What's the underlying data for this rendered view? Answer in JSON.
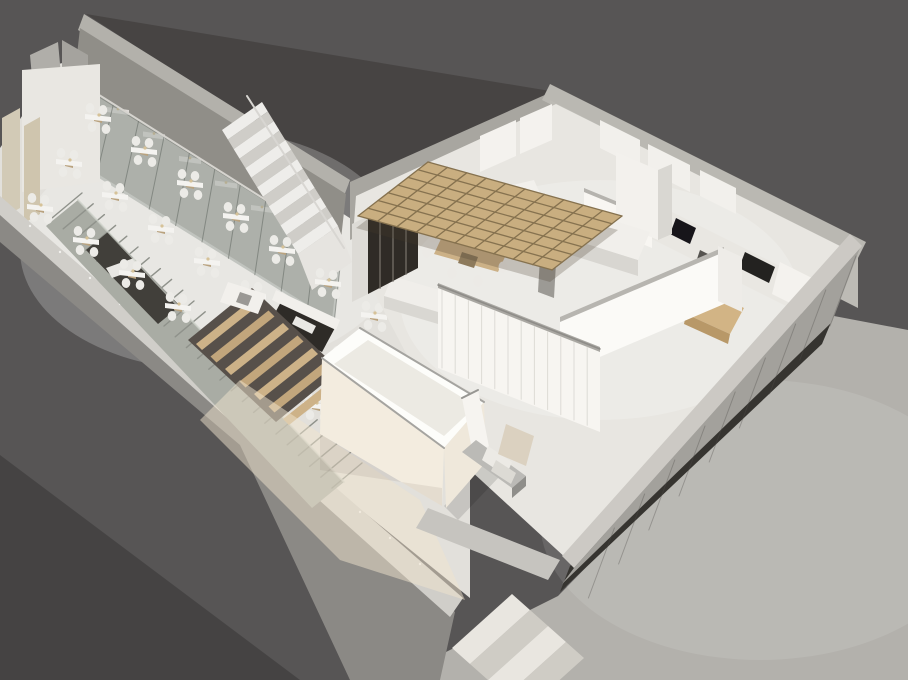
{
  "scene": {
    "name": "3d-axonometric-restaurant-floorplan-render",
    "canvas": {
      "width": 908,
      "height": 680
    },
    "palette": {
      "background": "#575555",
      "background_corner": "#434241",
      "roof_dark": "#474443",
      "wall_cap": "#cfcdc8",
      "wall_face_gray": "#8e8c88",
      "hall_floor": "#e2e0db",
      "kitchen_floor": "#e8e6e1",
      "sidewalk": "#b3b1ac",
      "glass_tint": "rgba(139,148,141,0.42)",
      "wood_light": "#cdb288",
      "pergola_wood": "#c9ae80",
      "dark_cabinet": "#2f2b26",
      "facade_base_dark": "#363430",
      "white_furniture": "#f2f0ec",
      "metal": "#bbbab6"
    },
    "shapes": [
      {
        "n": "background",
        "t": "r",
        "x": 0,
        "y": 0,
        "w": 908,
        "h": 680,
        "f": "#575555"
      },
      {
        "n": "background-corner-shade",
        "p": "0,455 300,680 0,680",
        "f": "#454343"
      },
      {
        "n": "roof-slab-dark",
        "p": "86,14 556,92 348,184",
        "f": "#474443"
      },
      {
        "n": "sidewalk",
        "p": "834,316 908,330 908,680 390,680 558,596 830,318",
        "f": "#b3b1ac"
      },
      {
        "n": "sidewalk-sheen",
        "t": "e",
        "cx": 760,
        "cy": 520,
        "rx": 220,
        "ry": 140,
        "f": "rgba(255,255,255,0.10)"
      },
      {
        "n": "hall-floor",
        "p": "96,56 356,222 470,400 470,598 0,218 0,148 58,64",
        "f": "#e2e0db"
      },
      {
        "n": "hall-floor-sheen",
        "t": "e",
        "cx": 210,
        "cy": 250,
        "rx": 190,
        "ry": 120,
        "f": "rgba(255,255,255,0.22)"
      },
      {
        "n": "backwall-cap",
        "p": "84,14 350,180 344,196 78,30",
        "f": "#b3b1ab"
      },
      {
        "n": "backwall-face",
        "p": "80,28 346,194 340,248 74,82",
        "f": "#908e88"
      },
      {
        "n": "glass-corridor-floor",
        "p": "74,82 340,248 332,320 66,154",
        "f": "#c7c5bf"
      },
      {
        "gen": "boothTables",
        "n": "booth-table",
        "origin": [
          118,
          110
        ],
        "step": [
          36,
          24.5
        ],
        "count": 7,
        "rel": [
          [
            -11,
            -3
          ],
          [
            11,
            0
          ],
          [
            11,
            5
          ],
          [
            -11,
            2
          ]
        ],
        "f": "#f0eeeb",
        "o": 0.8,
        "lamp": {
          "dx": 0,
          "dy": -1,
          "r": 1.4,
          "f": "#d6c298"
        }
      },
      {
        "n": "glass-partition",
        "p": "88,88 342,248 334,324 70,160",
        "f": "rgba(139,148,141,0.42)"
      },
      {
        "gen": "lines2",
        "n": "glass-mullion",
        "a0": [
          88,
          88
        ],
        "aStep": [
          25.4,
          16
        ],
        "b0": [
          70,
          160
        ],
        "bStep": [
          26.4,
          16.4
        ],
        "count": 11,
        "s": "rgba(90,95,90,0.5)",
        "sw": 1
      },
      {
        "n": "glass-top-rail",
        "t": "l",
        "x1": 88,
        "y1": 88,
        "x2": 342,
        "y2": 248,
        "s": "#d6d4cf",
        "sw": 2
      },
      {
        "n": "partition-wall-a",
        "p": "30,55 58,42 62,86 34,99",
        "f": "#b0aea9"
      },
      {
        "n": "partition-wall-b",
        "p": "62,40 88,55 88,95 62,80",
        "f": "#a5a39e"
      },
      {
        "n": "end-wall-white",
        "p": "22,70 100,64 100,182 22,192",
        "f": "#e9e7e2"
      },
      {
        "n": "beige-panel-1",
        "p": "2,118 20,108 20,208 2,218",
        "f": "#d2cab6"
      },
      {
        "n": "beige-panel-2",
        "p": "24,126 40,117 40,214 24,223",
        "f": "#cfc5ae"
      },
      {
        "n": "lower-wall-outer-face",
        "p": "0,212 455,612 440,680 350,680 240,445 0,242",
        "f": "#8b8985"
      },
      {
        "n": "lower-wall-cap",
        "p": "0,196 463,598 450,617 0,215",
        "f": "#d0cec9"
      },
      {
        "gen": "dots",
        "n": "cap-fastener",
        "start": [
          30,
          226
        ],
        "step": [
          30,
          26
        ],
        "count": 14,
        "r": 1.2,
        "f": "#f2f1ee"
      },
      {
        "n": "ramp-strip",
        "p": "46,226 78,200 344,482 312,508",
        "f": "#a9aca4"
      },
      {
        "gen": "lines",
        "n": "ramp-ridge",
        "from": [
          52,
          218
        ],
        "step": [
          11.2,
          10.8
        ],
        "count": 26,
        "vec": [
          30,
          -25
        ],
        "s": "#8f928b",
        "sw": 1.4
      },
      {
        "n": "ramp-inset-dark",
        "p": "86,250 108,232 180,306 158,324",
        "f": "#413f3a"
      },
      {
        "n": "ramp-inset-object",
        "p": "106,268 134,258 140,268 112,278",
        "f": "#e8e7e3"
      },
      {
        "n": "ramp-balustrade",
        "t": "l",
        "x1": 78,
        "y1": 200,
        "x2": 344,
        "y2": 482,
        "s": "#d0d4cc",
        "sw": 2,
        "o": 0.7
      },
      {
        "gen": "bands",
        "n": "stair-tread",
        "start": [
          222,
          130
        ],
        "w": [
          40,
          -28
        ],
        "f": [
          5.85,
          9.54
        ],
        "count": 13,
        "f1": "#eeedea",
        "f2": "#cfcdc8"
      },
      {
        "n": "stair-landing",
        "p": "298,254 338,226 352,262 312,290",
        "f": "#e6e4e0"
      },
      {
        "n": "stair-handrail",
        "t": "l",
        "x1": 247,
        "y1": 96,
        "x2": 344,
        "y2": 248,
        "s": "#d8d6d2",
        "sw": 2
      },
      {
        "gen": "tables",
        "n": "dining-table",
        "origin": [
          98,
          118
        ],
        "rowStep": [
          46,
          33
        ],
        "colStep": [
          -29,
          45
        ],
        "rows": 7,
        "cols": 3,
        "topRel": [
          [
            -13,
            -4
          ],
          [
            13,
            -1
          ],
          [
            13,
            4
          ],
          [
            -13,
            1
          ]
        ],
        "topF": "#f4f3f0",
        "baseRel": [
          [
            -4,
            0
          ],
          [
            4,
            2
          ],
          [
            4,
            5
          ],
          [
            -4,
            3
          ]
        ],
        "baseF": "#b9a27e",
        "chairs": [
          [
            -8,
            -10
          ],
          [
            5,
            -8
          ],
          [
            -6,
            9
          ],
          [
            8,
            11
          ]
        ],
        "chairR": [
          4.3,
          5
        ],
        "chairF": "#ecebe7",
        "lamp": {
          "dx": 1,
          "dy": -3,
          "r": 1.6,
          "f": "#d6c298"
        }
      },
      {
        "n": "stairwell-pit",
        "p": "282,300 336,326 322,352 268,326",
        "f": "#2e2b27"
      },
      {
        "n": "stairwell-object",
        "p": "296,316 316,326 312,334 292,324",
        "f": "#e9e8e4"
      },
      {
        "n": "stairwell-edge",
        "p": "276,290 340,320 336,330 272,300",
        "f": "#f1efeb"
      },
      {
        "n": "wood-steps-shadow",
        "p": "188,340 252,288 340,370 276,422",
        "f": "#57504a"
      },
      {
        "gen": "beams",
        "n": "wood-step-beam",
        "start": [
          196,
          344
        ],
        "step": [
          14.5,
          12.5
        ],
        "count": 7,
        "vec": [
          58,
          -46
        ],
        "wvec": [
          6,
          6
        ],
        "f1": "#cdb288",
        "f2": "#c2a67c"
      },
      {
        "n": "host-table",
        "p": "228,282 266,294 258,314 220,302",
        "f": "#f2f0ec"
      },
      {
        "n": "host-table-item",
        "p": "240,292 252,296 248,306 236,302",
        "f": "#9a9894"
      },
      {
        "n": "kitchen-nw-wall",
        "p": "350,182 556,90 556,148 350,240",
        "f": "#a8a6a0"
      },
      {
        "n": "kitchen-ne-cap",
        "p": "550,84 866,242 858,258 542,100",
        "f": "#bab8b2"
      },
      {
        "n": "kitchen-ne-wall",
        "p": "550,100 858,256 858,308 550,152",
        "f": "#bdbbb5"
      },
      {
        "n": "kitchen-floor",
        "p": "356,196 556,104 852,252 568,560 470,470 420,380 352,250",
        "f": "#e8e6e1"
      },
      {
        "n": "kitchen-floor-sheen",
        "t": "e",
        "cx": 600,
        "cy": 300,
        "rx": 200,
        "ry": 120,
        "f": "rgba(255,255,255,0.2)"
      },
      {
        "n": "upper-cabinet-1",
        "p": "520,118 552,104 552,140 520,154",
        "f": "#f4f2ee"
      },
      {
        "n": "upper-cabinet-2",
        "p": "480,136 516,120 516,156 480,172",
        "f": "#f4f2ee"
      },
      {
        "n": "upper-cabinet-3",
        "p": "600,120 640,140 640,168 600,148",
        "f": "#f2f0ec"
      },
      {
        "n": "upper-cabinet-4",
        "p": "648,144 690,165 690,192 648,171",
        "f": "#f2f0ec"
      },
      {
        "n": "upper-cabinet-5",
        "p": "700,170 736,188 736,214 700,196",
        "f": "#f2f0ec"
      },
      {
        "n": "ne-counter",
        "p": "640,196 820,286 806,316 626,226",
        "f": "#e9e7e2"
      },
      {
        "n": "oven-dark",
        "p": "676,218 696,228 690,244 670,234",
        "f": "#17151a"
      },
      {
        "n": "appliance-dark",
        "p": "745,252 775,267 769,283 739,268",
        "f": "#232220"
      },
      {
        "n": "counter-slot-dark",
        "p": "700,250 740,270 736,282 696,262",
        "f": "#55534f"
      },
      {
        "n": "tall-fridge",
        "p": "780,262 812,278 804,310 772,294",
        "f": "#f4f2ee"
      },
      {
        "n": "wood-side-table",
        "p": "700,288 744,308 730,334 686,314",
        "f": "#d2b485"
      },
      {
        "n": "wood-side-table-face",
        "p": "686,314 730,334 728,344 684,324",
        "f": "#b89868"
      },
      {
        "n": "wall-c-cap",
        "p": "584,188 652,216 652,222 584,194",
        "f": "#b5b3ae"
      },
      {
        "n": "wall-c",
        "p": "584,192 652,220 652,248 584,220",
        "f": "#f8f6f2"
      },
      {
        "n": "mid-tall-cabinet",
        "p": "616,152 658,170 658,240 616,222",
        "f": "#f3f1ed"
      },
      {
        "n": "mid-tall-cabinet-side",
        "p": "658,170 672,164 672,234 658,240",
        "f": "#d9d7d2"
      },
      {
        "n": "island-front",
        "p": "478,228 548,212 548,232 478,248",
        "f": "#dcdad5"
      },
      {
        "n": "island-top",
        "p": "464,196 534,180 548,212 478,228",
        "f": "#f2f0ec"
      },
      {
        "n": "cooktop",
        "p": "500,196 528,190 534,204 506,210",
        "f": "#1c1a18"
      },
      {
        "n": "counter2-front",
        "p": "536,228 638,260 638,276 536,244",
        "f": "#d8d6d1"
      },
      {
        "n": "counter2-top",
        "p": "548,200 650,232 638,260 536,228",
        "f": "#f1efeb"
      },
      {
        "n": "support-column",
        "p": "542,222 558,228 554,298 538,292",
        "f": "#9c9a95"
      },
      {
        "n": "wood-dining-table",
        "p": "446,228 510,246 498,272 434,254",
        "f": "#ccb187"
      },
      {
        "n": "table-pedestal",
        "p": "462,252 478,257 474,268 458,263",
        "f": "#8d7a5c"
      },
      {
        "n": "chair",
        "t": "e",
        "cx": 433,
        "cy": 237,
        "rx": 4.5,
        "ry": 5.5,
        "f": "#eceae6"
      },
      {
        "n": "chair",
        "t": "e",
        "cx": 427,
        "cy": 252,
        "rx": 4.5,
        "ry": 5.5,
        "f": "#eceae6"
      },
      {
        "n": "chair",
        "t": "e",
        "cx": 452,
        "cy": 273,
        "rx": 4.5,
        "ry": 5.5,
        "f": "#eceae6"
      },
      {
        "n": "chair",
        "t": "e",
        "cx": 478,
        "cy": 281,
        "rx": 4.5,
        "ry": 5.5,
        "f": "#eceae6"
      },
      {
        "n": "chair",
        "t": "e",
        "cx": 503,
        "cy": 267,
        "rx": 4.5,
        "ry": 5.5,
        "f": "#eceae6"
      },
      {
        "n": "chair",
        "t": "e",
        "cx": 463,
        "cy": 222,
        "rx": 4.5,
        "ry": 5.5,
        "f": "#eceae6"
      },
      {
        "n": "chair",
        "t": "e",
        "cx": 488,
        "cy": 229,
        "rx": 4.5,
        "ry": 5.5,
        "f": "#eceae6"
      },
      {
        "n": "low-cabinet",
        "p": "392,276 446,292 438,312 384,296",
        "f": "#f0eeea"
      },
      {
        "n": "low-cabinet-front",
        "p": "384,296 438,312 438,324 384,308",
        "f": "#d9d7d2"
      },
      {
        "n": "wine-cabinet-top",
        "p": "368,212 418,186 418,192 368,218",
        "f": "#e8e6e2"
      },
      {
        "n": "wine-cabinet-side",
        "p": "352,224 368,216 368,294 352,302",
        "f": "#dddbd6"
      },
      {
        "n": "wine-cabinet-front",
        "p": "368,216 418,190 418,268 368,294",
        "f": "#2f2b26"
      },
      {
        "n": "wine-cabinet-divider",
        "t": "l",
        "x1": 380,
        "y1": 210,
        "x2": 380,
        "y2": 288,
        "s": "#6b665f",
        "sw": 1.5
      },
      {
        "n": "wine-cabinet-divider",
        "t": "l",
        "x1": 393,
        "y1": 203,
        "x2": 393,
        "y2": 281,
        "s": "#6b665f",
        "sw": 1.5
      },
      {
        "n": "wine-cabinet-divider",
        "t": "l",
        "x1": 406,
        "y1": 196,
        "x2": 406,
        "y2": 274,
        "s": "#6b665f",
        "sw": 1.5
      },
      {
        "n": "pergola-shadow",
        "p": "424,176 618,230 550,282 356,228",
        "f": "rgba(70,60,45,0.25)"
      },
      {
        "n": "pergola-deck",
        "p": "428,162 622,216 552,270 358,216",
        "f": "#c9ae80"
      },
      {
        "gen": "lines",
        "n": "pergola-joist-a",
        "from": [
          428,
          162
        ],
        "step": [
          19.4,
          5.4
        ],
        "count": 11,
        "vec": [
          -70,
          54
        ],
        "s": "#86724f",
        "sw": 1.3
      },
      {
        "gen": "lines",
        "n": "pergola-joist-b",
        "from": [
          428,
          162
        ],
        "step": [
          -10,
          7.7
        ],
        "count": 8,
        "vec": [
          194,
          54
        ],
        "s": "#86724f",
        "sw": 1.3
      },
      {
        "n": "wall-b-cap",
        "p": "560,317 724,247 724,254 560,324",
        "f": "#b7b5b0"
      },
      {
        "n": "wall-b",
        "p": "560,322 724,252 724,304 560,374",
        "f": "#fbfaf7"
      },
      {
        "n": "wall-b-endcap",
        "p": "718,246 742,257 742,312 718,301",
        "f": "#eeece8"
      },
      {
        "n": "street-wall-cap",
        "p": "438,283 600,347 600,354 438,290",
        "f": "#a9a7a2"
      },
      {
        "n": "street-wall",
        "p": "438,288 600,352 600,432 438,368",
        "f": "#f7f5f1"
      },
      {
        "gen": "lines",
        "n": "street-wall-slat",
        "from": [
          442,
          290
        ],
        "step": [
          13.2,
          5.2
        ],
        "count": 12,
        "vec": [
          0,
          78
        ],
        "s": "#dddbd6",
        "sw": 1
      },
      {
        "n": "street-wall-metal",
        "t": "l",
        "x1": 438,
        "y1": 285,
        "x2": 600,
        "y2": 349,
        "s": "#8e8c88",
        "sw": 1.5
      },
      {
        "n": "corridor-warm-floor",
        "p": "240,380 420,500 465,600 340,560 200,420",
        "f": "rgba(240,228,205,0.5)"
      },
      {
        "n": "box-shadow",
        "p": "444,506 486,462 500,476 458,520",
        "f": "rgba(0,0,0,0.12)"
      },
      {
        "n": "box-rim",
        "p": "360,328 484,402 444,448 322,358",
        "f": "#fdfdfa"
      },
      {
        "n": "box-interior",
        "p": "368,340 476,406 444,436 334,364",
        "f": "#eceae3"
      },
      {
        "n": "box-west-face",
        "p": "322,358 444,448 442,506 320,434",
        "f": "#f3ecdf"
      },
      {
        "n": "box-west-shade",
        "p": "320,470 442,488 442,506 320,434",
        "f": "rgba(120,110,95,0.12)"
      },
      {
        "n": "box-south-face",
        "p": "444,448 484,402 486,462 446,508",
        "f": "#efe8db"
      },
      {
        "n": "box-rim-metal",
        "t": "l",
        "x1": 360,
        "y1": 328,
        "x2": 484,
        "y2": 402,
        "s": "#a5a4a0",
        "sw": 2
      },
      {
        "n": "box-rim-metal",
        "t": "l",
        "x1": 322,
        "y1": 358,
        "x2": 444,
        "y2": 448,
        "s": "#a5a4a0",
        "sw": 2
      },
      {
        "n": "column-stub",
        "p": "462,398 478,390 490,452 474,460",
        "f": "#f6f4f0"
      },
      {
        "n": "column-stub-cap",
        "t": "l",
        "x1": 462,
        "y1": 398,
        "x2": 478,
        "y2": 390,
        "s": "#979692",
        "sw": 2
      },
      {
        "n": "steel-bench-top",
        "p": "462,452 476,440 526,476 512,488",
        "f": "#bbbab6"
      },
      {
        "n": "steel-bench-front",
        "p": "512,488 526,476 526,486 512,498",
        "f": "#8f8e8a"
      },
      {
        "n": "mini-step-1",
        "p": "488,446 512,462 506,476 482,460",
        "f": "#eceae5"
      },
      {
        "n": "mini-step-2",
        "p": "496,460 516,473 511,484 491,471",
        "f": "#dcdad4"
      },
      {
        "n": "beige-block",
        "p": "506,424 534,436 526,466 498,454",
        "f": "#dbd1c0"
      },
      {
        "n": "entrance-parapet",
        "p": "428,508 560,560 548,580 416,528",
        "f": "#c6c4bf"
      },
      {
        "gen": "bands",
        "n": "entrance-step",
        "start": [
          452,
          648
        ],
        "w": [
          60,
          -54
        ],
        "f": [
          18,
          16
        ],
        "count": 4,
        "f1": "#e9e6e0",
        "f2": "#cfccc5"
      },
      {
        "n": "facade-base-dark",
        "p": "832,320 570,566 560,592 822,344",
        "f": "#363430"
      },
      {
        "n": "facade-glass-face",
        "p": "860,248 574,568 562,584 832,322",
        "f": "#a3a19c"
      },
      {
        "gen": "lines",
        "n": "facade-panel-line",
        "from": [
          856,
          256
        ],
        "step": [
          -30.2,
          34
        ],
        "count": 9,
        "vec": [
          -26,
          70
        ],
        "s": "rgba(80,78,74,0.35)",
        "sw": 1
      },
      {
        "n": "facade-cap",
        "p": "850,234 862,246 574,568 562,556",
        "f": "#ccc9c4"
      }
    ]
  }
}
